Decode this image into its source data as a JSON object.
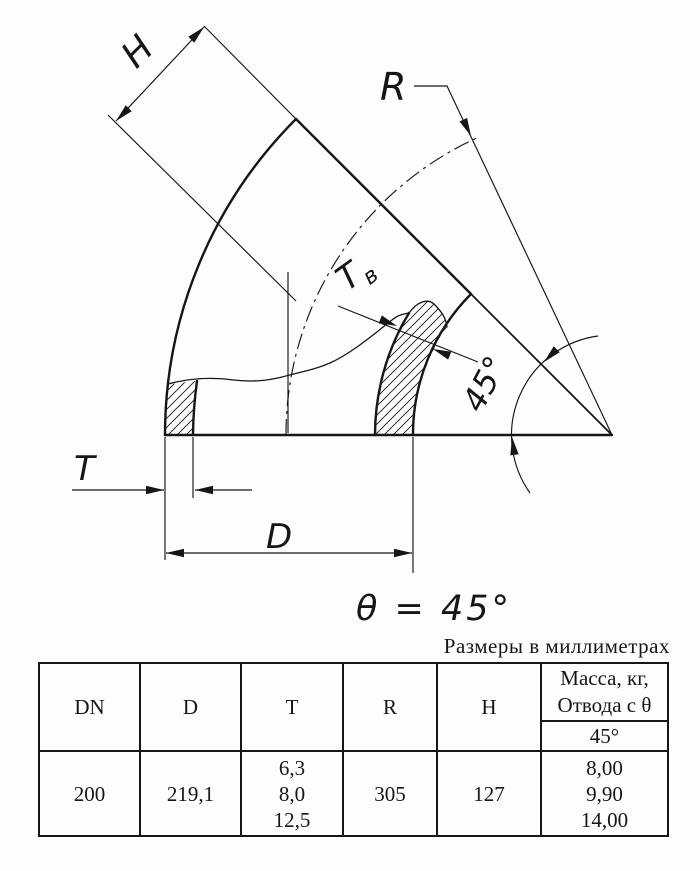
{
  "drawing": {
    "title_note": "Размеры в миллиметрах",
    "labels": {
      "h": "H",
      "r": "R",
      "t": "T",
      "tv_main": "T",
      "tv_sub": "в",
      "d": "D",
      "angle": "45°",
      "theta_equation": "θ = 45°"
    }
  },
  "table": {
    "headers": {
      "dn": "DN",
      "d": "D",
      "t": "T",
      "r": "R",
      "h": "H",
      "mass_line1": "Масса, кг,",
      "mass_line2": "Отвода с θ",
      "mass_sub": "45°"
    },
    "row": {
      "dn": "200",
      "d": "219,1",
      "t": [
        "6,3",
        "8,0",
        "12,5"
      ],
      "r": "305",
      "h": "127",
      "mass": [
        "8,00",
        "9,90",
        "14,00"
      ]
    }
  },
  "colors": {
    "ink": "#161616",
    "paper": "#fdfdfd"
  }
}
